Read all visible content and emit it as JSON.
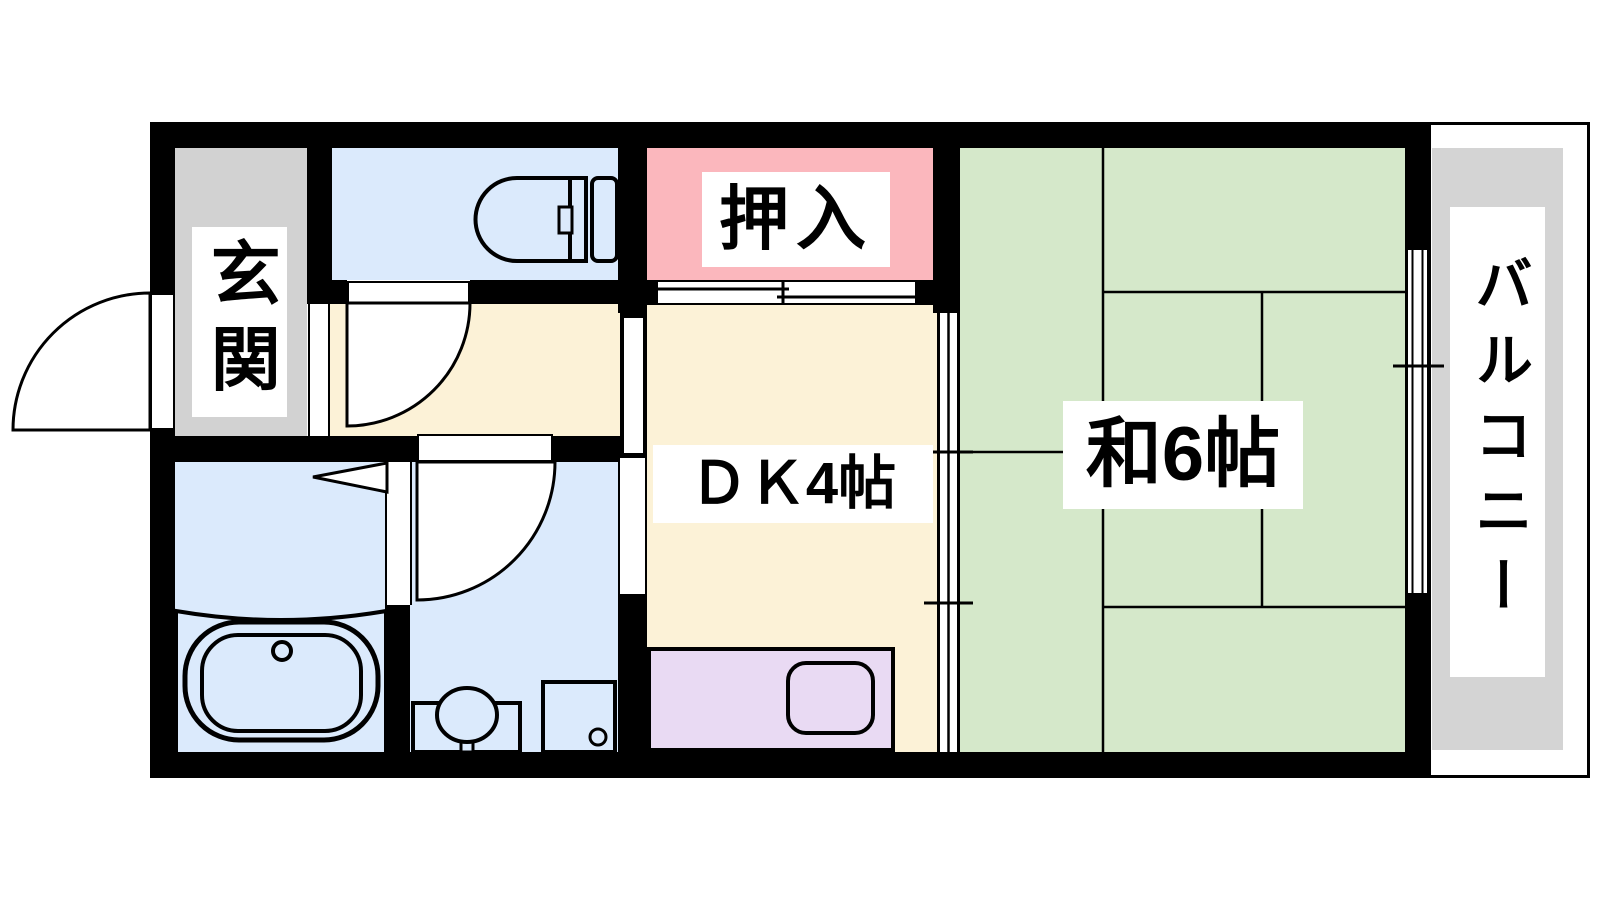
{
  "page": {
    "background": "#ffffff"
  },
  "floorplan": {
    "labels": {
      "genkan": "玄関",
      "oshiire": "押入",
      "dk": "ＤＫ4帖",
      "washitsu": "和6帖",
      "balcony": "バルコニー"
    },
    "colors": {
      "wall": "#000000",
      "genkan": "#d2d2d2",
      "water": "#dbeafc",
      "oshiire": "#fbb7bd",
      "dk": "#fcf2d7",
      "tatami": "#d5e8ca",
      "kitchen": "#e9daf3",
      "balcony": "#d4d4d4",
      "label_bg": "#ffffff",
      "text": "#000000"
    },
    "icons": {
      "toilet": "toilet-icon",
      "bathtub": "bathtub-icon",
      "washbasin": "washbasin-icon",
      "washing_machine": "washing-machine-icon",
      "kitchen_sink": "kitchen-sink-icon",
      "doors": [
        "entrance-door-arc",
        "toilet-door-arc",
        "washroom-door-arc",
        "bathroom-door-swing",
        "sliding-door",
        "fusuma-door",
        "window"
      ]
    }
  }
}
